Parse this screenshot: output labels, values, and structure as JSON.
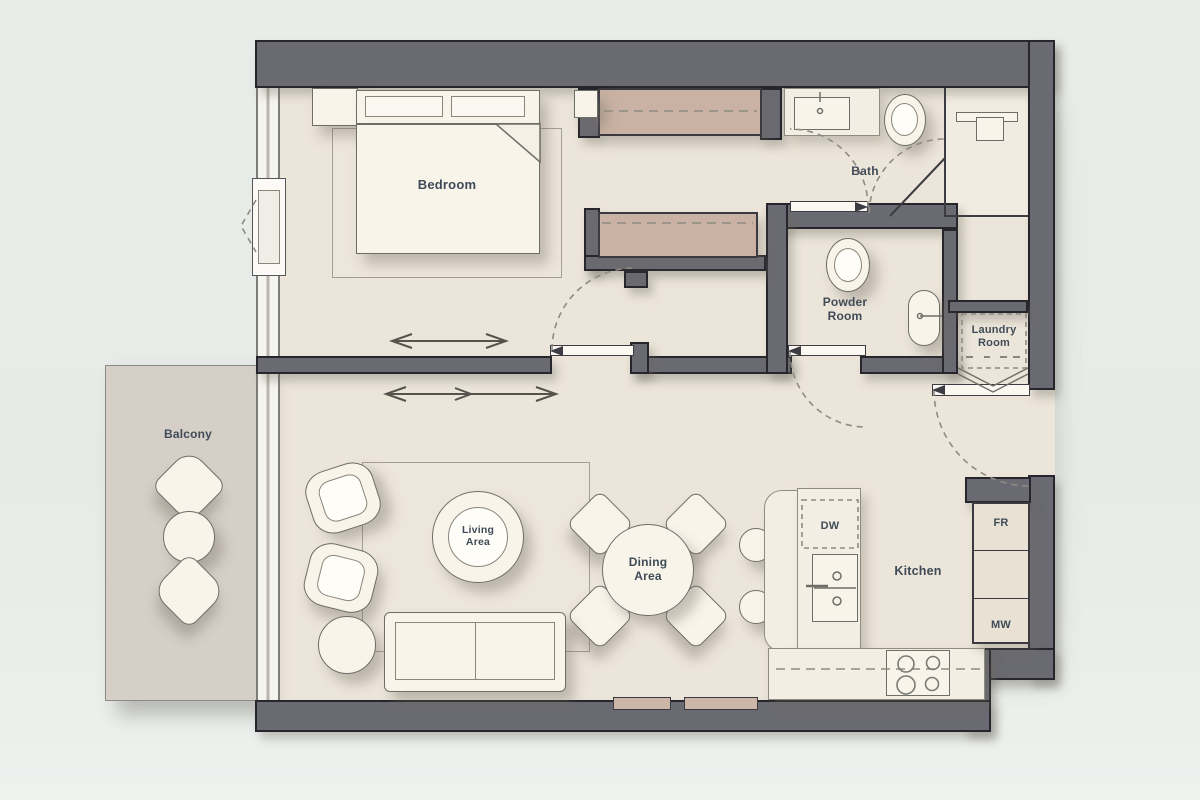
{
  "plan_title": "One-bedroom apartment floor plan",
  "rooms": {
    "bedroom": {
      "label": "Bedroom"
    },
    "bath": {
      "label": "Bath"
    },
    "powder_room": {
      "label": "Powder\nRoom"
    },
    "laundry_room": {
      "label": "Laundry\nRoom"
    },
    "kitchen": {
      "label": "Kitchen"
    },
    "living_area": {
      "label": "Living\nArea"
    },
    "dining_area": {
      "label": "Dining\nArea"
    },
    "balcony": {
      "label": "Balcony"
    }
  },
  "appliances": {
    "dishwasher": "DW",
    "fridge": "FR",
    "microwave": "MW"
  },
  "colors": {
    "background": "#e8ece8",
    "wall": "#6a6a72",
    "wall_outline": "#26262c",
    "floor": "#ece5d9",
    "balcony_floor": "#d5cfc7",
    "wardrobe": "#c9b2a3",
    "furniture": "#f8f4ea",
    "label_text": "#3f4b57"
  }
}
